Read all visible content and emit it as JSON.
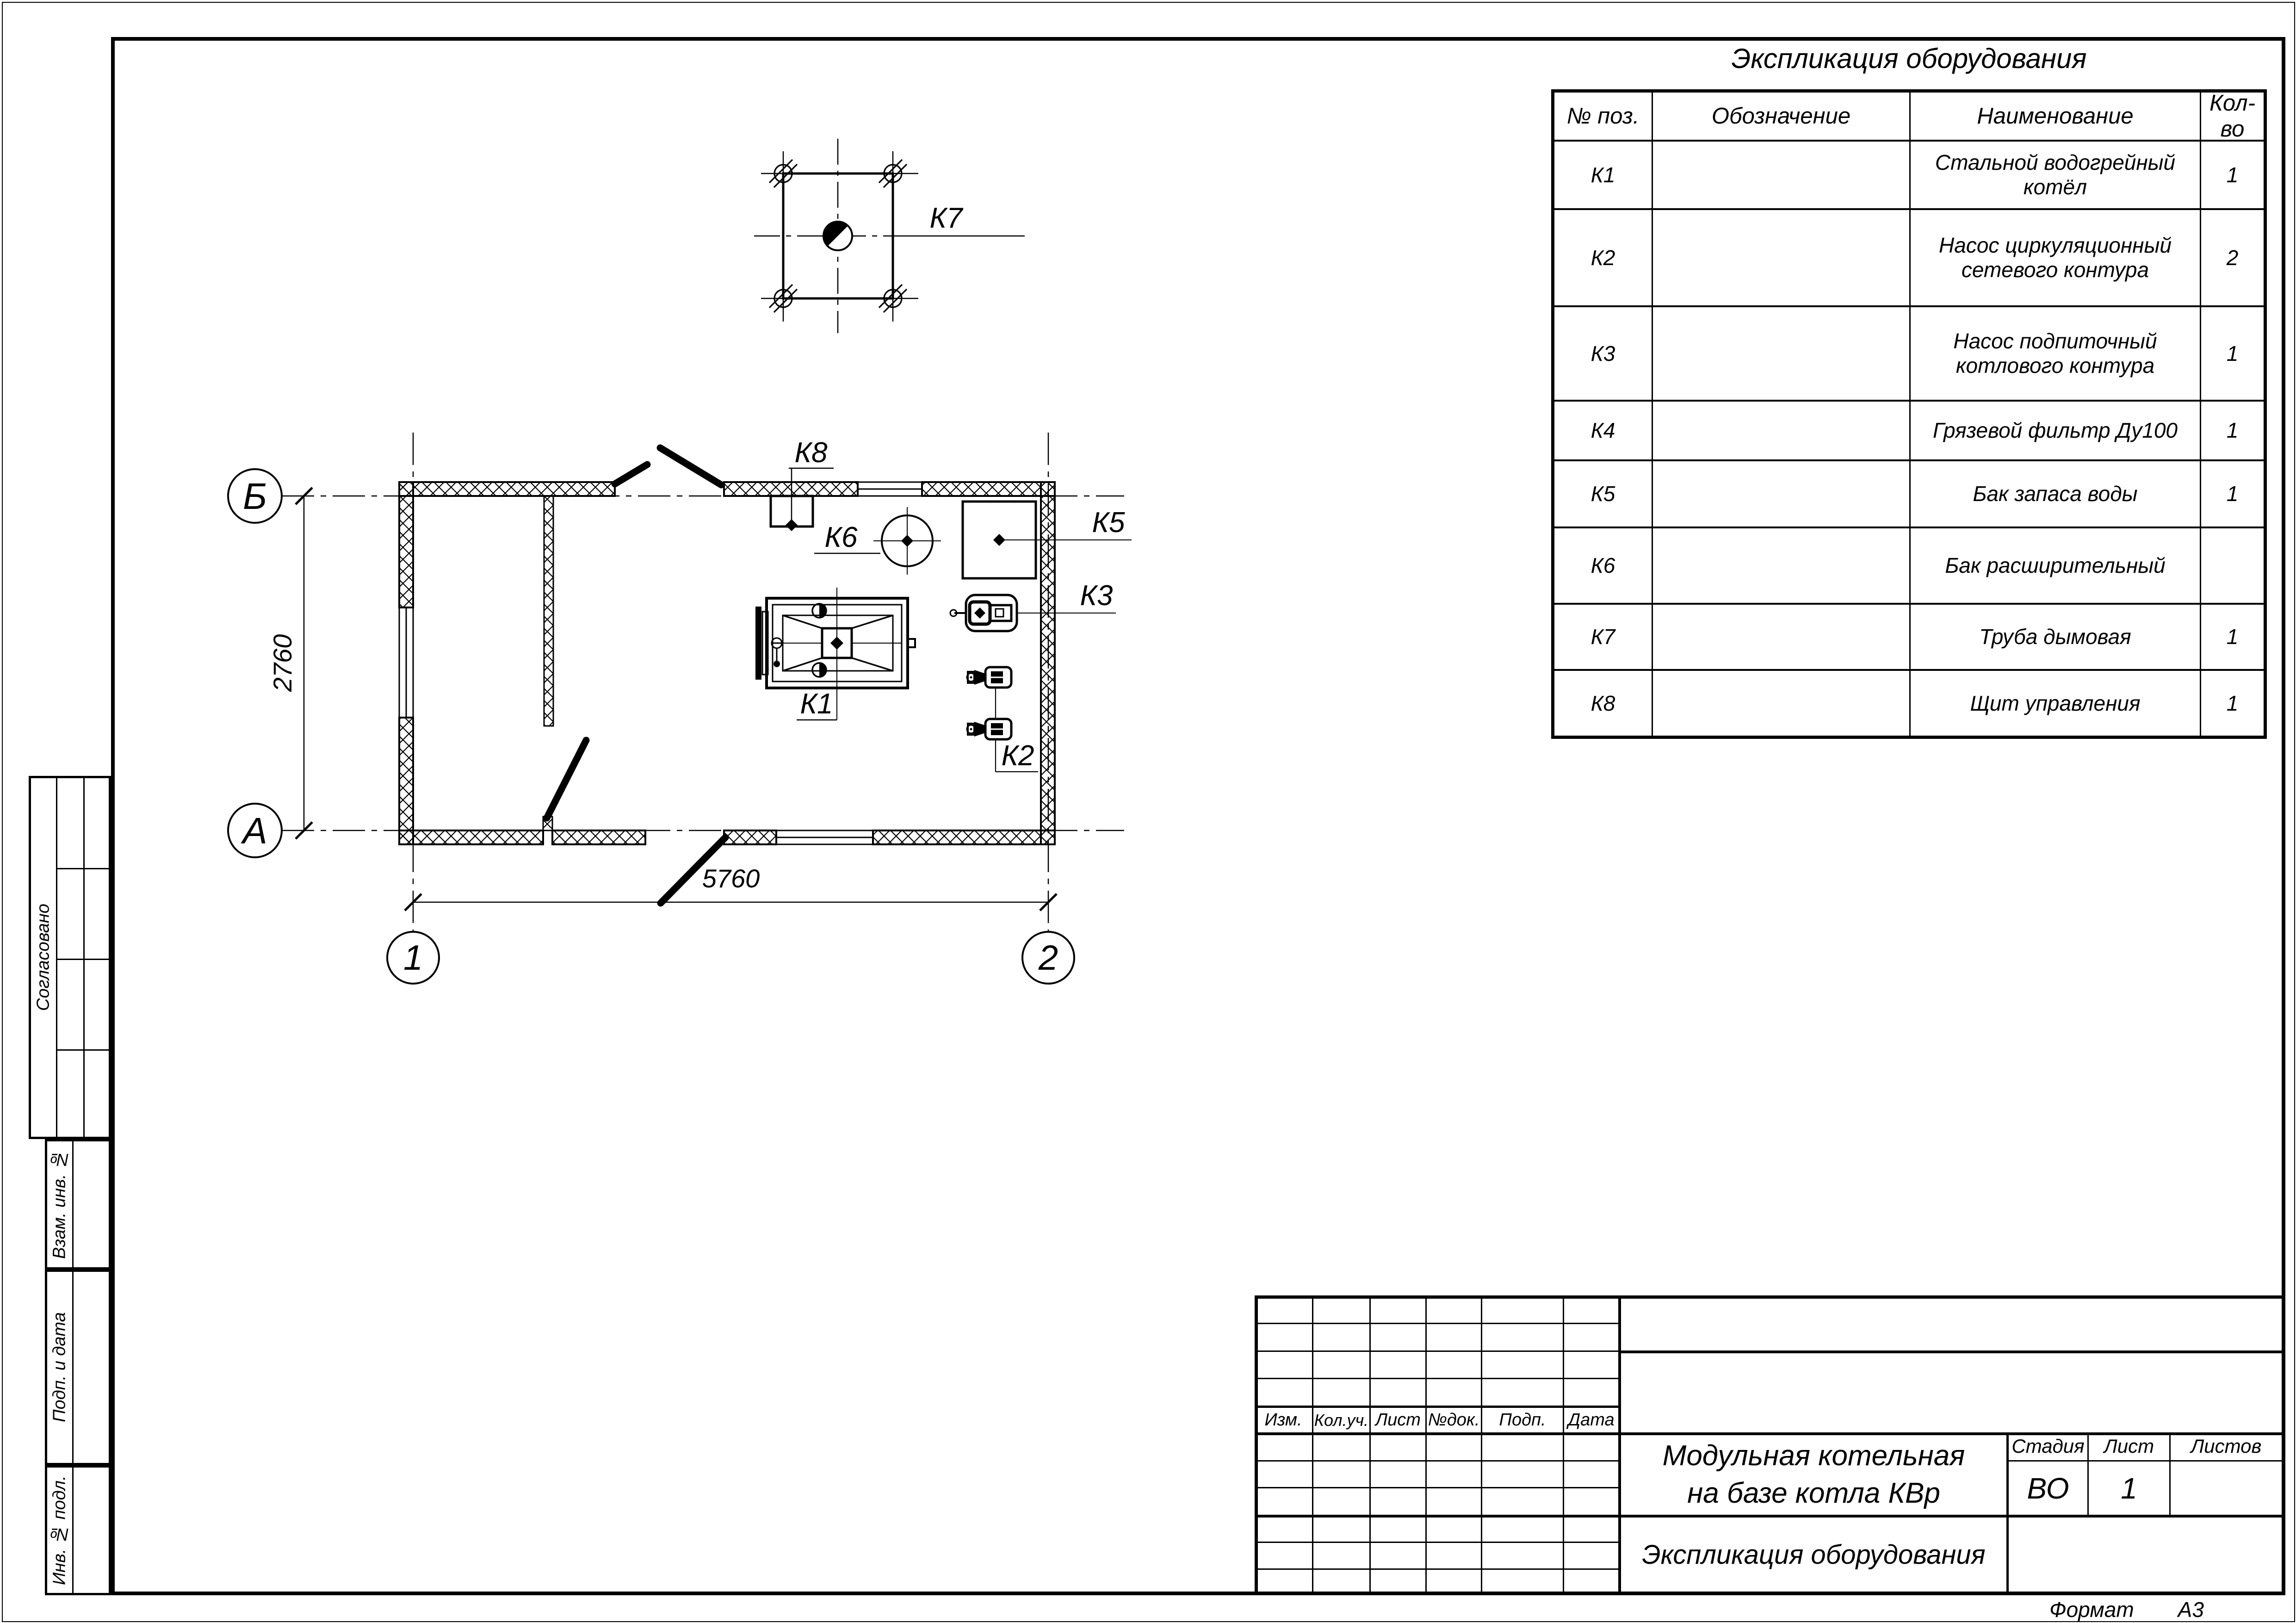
{
  "table": {
    "title": "Экспликация оборудования",
    "headers": [
      "№ поз.",
      "Обозначение",
      "Наименование",
      "Кол-во"
    ],
    "rows": [
      {
        "pos": "К1",
        "designation": "",
        "name": "Стальной водогрейный котёл",
        "qty": "1"
      },
      {
        "pos": "К2",
        "designation": "",
        "name": "Насос циркуляционный сетевого контура",
        "qty": "2"
      },
      {
        "pos": "К3",
        "designation": "",
        "name": "Насос подпиточный котлового контура",
        "qty": "1"
      },
      {
        "pos": "К4",
        "designation": "",
        "name": "Грязевой фильтр Ду100",
        "qty": "1"
      },
      {
        "pos": "К5",
        "designation": "",
        "name": "Бак запаса воды",
        "qty": "1"
      },
      {
        "pos": "К6",
        "designation": "",
        "name": "Бак расширительный",
        "qty": ""
      },
      {
        "pos": "К7",
        "designation": "",
        "name": "Труба дымовая",
        "qty": "1"
      },
      {
        "pos": "К8",
        "designation": "",
        "name": "Щит управления",
        "qty": "1"
      }
    ]
  },
  "plan": {
    "axis": {
      "b": "Б",
      "a": "А",
      "one": "1",
      "two": "2"
    },
    "dims": {
      "width": "5760",
      "height": "2760"
    },
    "tags": {
      "k1": "К1",
      "k2": "К2",
      "k3": "К3",
      "k5": "К5",
      "k6": "К6",
      "k7": "К7",
      "k8": "К8"
    }
  },
  "title_block": {
    "rev_headers": [
      "Изм.",
      "Кол.уч.",
      "Лист",
      "№док.",
      "Подп.",
      "Дата"
    ],
    "doc_title_line1": "Модульная котельная",
    "doc_title_line2": "на базе котла КВр",
    "sheet_title": "Экспликация оборудования",
    "stage_label": "Стадия",
    "stage_value": "ВО",
    "sheet_label": "Лист",
    "sheet_value": "1",
    "sheets_label": "Листов",
    "sheets_value": "",
    "format_label": "Формат",
    "format_value": "А3"
  },
  "side_stamp": {
    "approved": "Согласовано",
    "replace_inv": "Взам. инв. №",
    "sign_date": "Подп. и дата",
    "inv_orig": "Инв. № подл."
  },
  "colors": {
    "ink": "#000000",
    "paper": "#ffffff"
  }
}
